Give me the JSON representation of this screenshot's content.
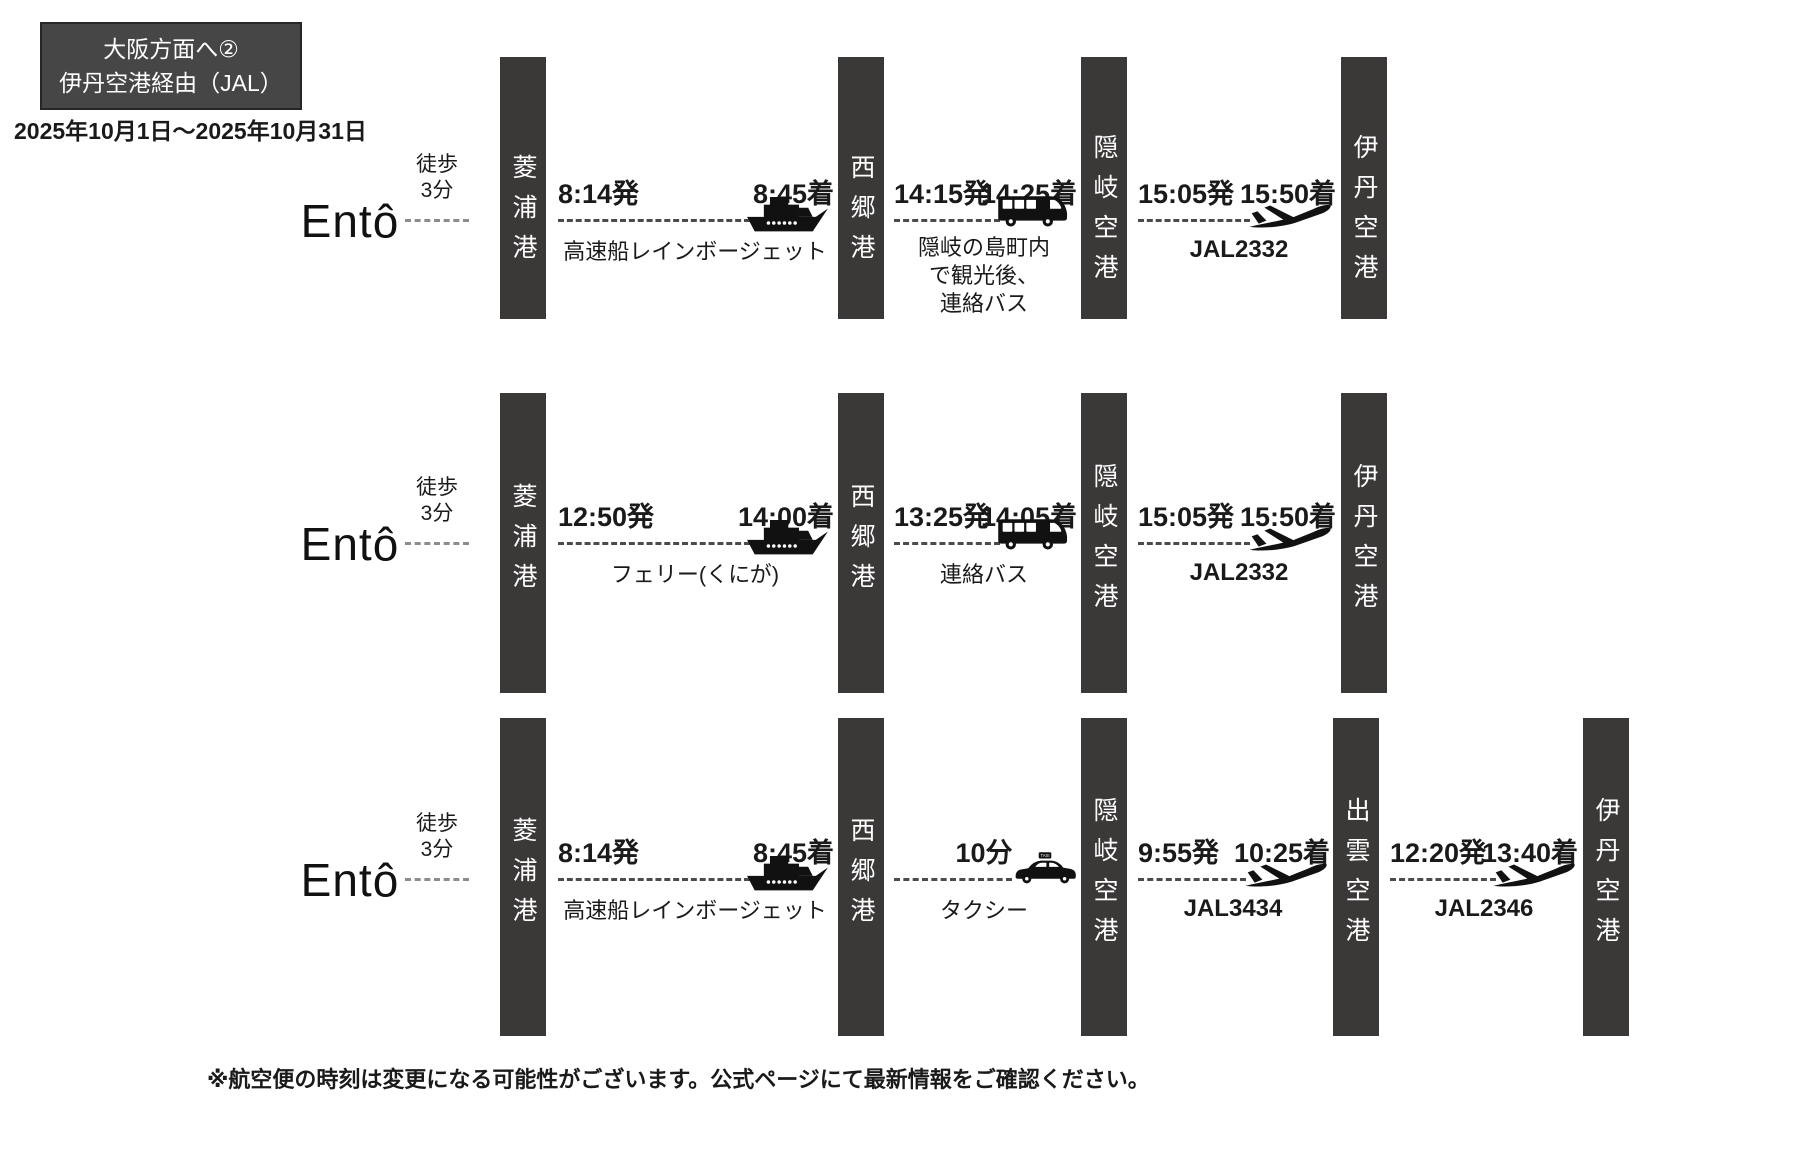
{
  "header": {
    "title_line1": "大阪方面へ②",
    "title_line2": "伊丹空港経由（JAL）",
    "date_range": "2025年10月1日～2025年10月31日"
  },
  "origin": {
    "logo": "Entô",
    "walk_line1": "徒歩",
    "walk_line2": "3分"
  },
  "footnote": "※航空便の時刻は変更になる可能性がございます。公式ページにて最新情報をご確認ください。",
  "colors": {
    "station_bar": "#3b3838",
    "title_box_bg": "#464646",
    "title_box_border": "#262626",
    "dash_line": "#4f4a4a",
    "text": "#1a1a1a",
    "station_text": "#ffffff"
  },
  "icons": {
    "ferry": "ferry-icon",
    "bus": "bus-icon",
    "plane": "plane-icon",
    "taxi": "taxi-icon"
  },
  "routes": [
    {
      "stations": [
        "菱浦港",
        "西郷港",
        "隠岐空港",
        "伊丹空港"
      ],
      "segments": [
        {
          "icon": "ferry-icon",
          "depart": "8:14発",
          "arrive": "8:45着",
          "label": "高速船レインボージェット"
        },
        {
          "icon": "bus-icon",
          "depart": "14:15発",
          "arrive": "14:25着",
          "label_lines": [
            "隠岐の島町内",
            "で観光後、",
            "連絡バス"
          ]
        },
        {
          "icon": "plane-icon",
          "depart": "15:05発",
          "arrive": "15:50着",
          "label": "JAL2332"
        }
      ]
    },
    {
      "stations": [
        "菱浦港",
        "西郷港",
        "隠岐空港",
        "伊丹空港"
      ],
      "segments": [
        {
          "icon": "ferry-icon",
          "depart": "12:50発",
          "arrive": "14:00着",
          "label": "フェリー(くにが)"
        },
        {
          "icon": "bus-icon",
          "depart": "13:25発",
          "arrive": "14:05着",
          "label": "連絡バス"
        },
        {
          "icon": "plane-icon",
          "depart": "15:05発",
          "arrive": "15:50着",
          "label": "JAL2332"
        }
      ]
    },
    {
      "stations": [
        "菱浦港",
        "西郷港",
        "隠岐空港",
        "出雲空港",
        "伊丹空港"
      ],
      "segments": [
        {
          "icon": "ferry-icon",
          "depart": "8:14発",
          "arrive": "8:45着",
          "label": "高速船レインボージェット"
        },
        {
          "icon": "taxi-icon",
          "duration": "10分",
          "label": "タクシー"
        },
        {
          "icon": "plane-icon",
          "depart": "9:55発",
          "arrive": "10:25着",
          "label": "JAL3434"
        },
        {
          "icon": "plane-icon",
          "depart": "12:20発",
          "arrive": "13:40着",
          "label": "JAL2346"
        }
      ]
    }
  ]
}
